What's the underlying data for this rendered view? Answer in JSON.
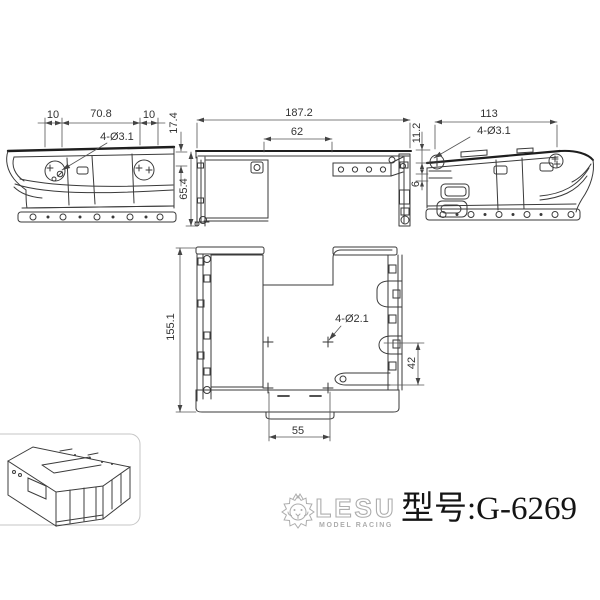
{
  "views": {
    "side_left": {
      "dim_top_left": "10",
      "dim_top_center": "70.8",
      "dim_top_right": "10",
      "hole_label": "4-Ø3.1",
      "dim_flange_height": "17.4",
      "dim_body_height": "65.4"
    },
    "top": {
      "dim_overall_width": "187.2",
      "dim_inner_width": "62"
    },
    "side_right": {
      "dim_width": "113",
      "hole_label": "4-Ø3.1",
      "dim_step_upper": "11.2",
      "dim_step_lower": "6"
    },
    "plan": {
      "dim_overall_height": "155.1",
      "hole_label": "4-Ø2.1",
      "dim_hole_spacing": "42",
      "dim_tab_width": "55"
    }
  },
  "brand": {
    "name": "LESU",
    "tagline": "MODEL RACING"
  },
  "title": {
    "model_label": "型号:G-6269"
  },
  "colors": {
    "line": "#3a3a3a",
    "dimension": "#444444",
    "brand_gray": "#adadad",
    "title_text": "#141414"
  }
}
